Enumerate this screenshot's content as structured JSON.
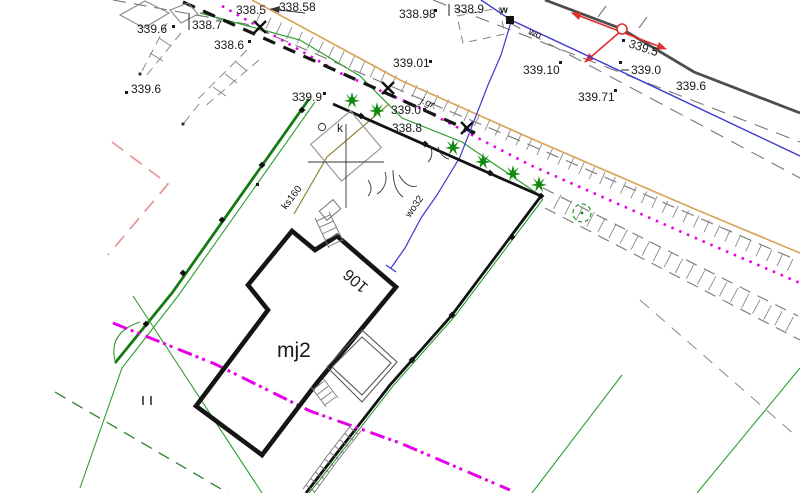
{
  "labels": {
    "elev_338_5": "338.5",
    "elev_338_58": "338.58",
    "elev_338_7": "338.7",
    "elev_339_6_a": "339.6",
    "elev_338_6": "338.6",
    "elev_339_6_b": "339.6",
    "elev_338_98": "338.98",
    "elev_338_9": "338.9",
    "elev_339_01": "339.01",
    "elev_339_10": "339.10",
    "elev_339_0_a": "339.0",
    "elev_339_6_c": "339.6",
    "elev_339_71": "339.71",
    "elev_339_5": "339.5",
    "elev_339_9": "339.9",
    "elev_339_0_b": "339.0",
    "elev_338_8": "338.8"
  },
  "annotations": {
    "boundary_abbr": "j.gr.",
    "water_node": "w",
    "water_main": "wo",
    "water_service": "wo32",
    "sewer_line": "ks160",
    "well_mark": "k",
    "house_number": "106",
    "building_label": "mj2",
    "gate_symbol": "||"
  },
  "colors": {
    "parcel_fence_green": "#157a15",
    "boundary_thin_green": "#2f9e2f",
    "utility_magenta": "#e600e6",
    "road_edge_tan": "#d9a45b",
    "water_blue": "#3a3ad0",
    "survey_red": "#e03030",
    "design_salmon": "#e89090",
    "road_gray": "#777777",
    "building_black": "#151515",
    "sewer_olive": "#8a7a20"
  }
}
